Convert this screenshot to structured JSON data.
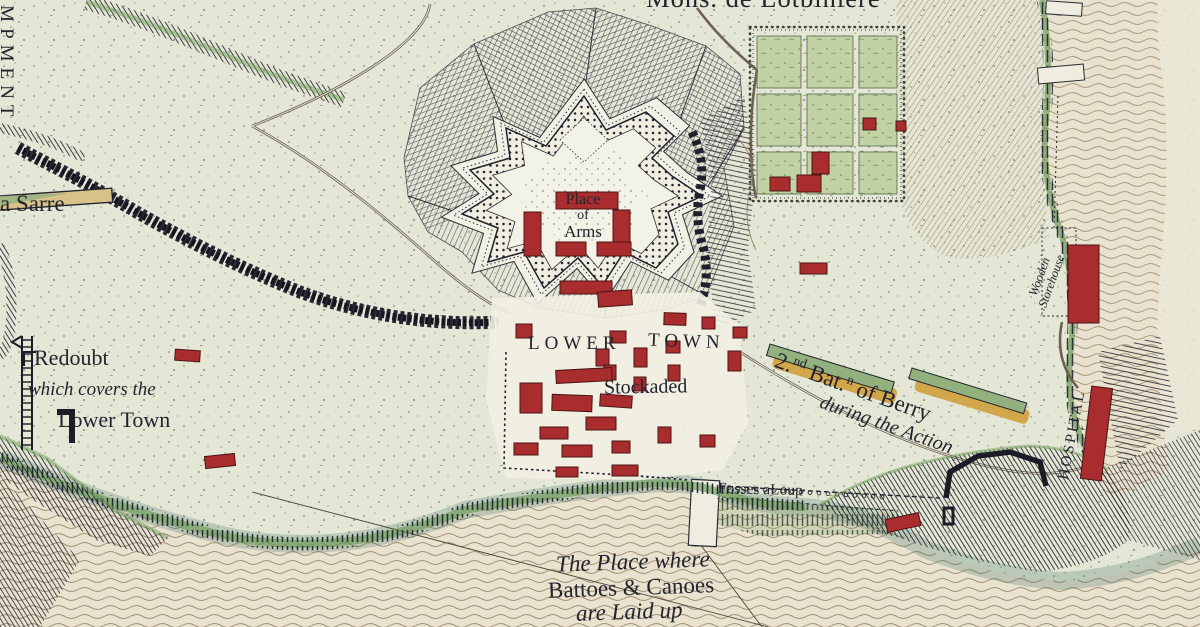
{
  "colors": {
    "ink": "#23232e",
    "paper": "#eae4d2",
    "land": "#e4e7d5",
    "water_shore_teal": "#3e7065",
    "shore_green": "#6c9a58",
    "building_red": "#a92c2e",
    "bar_green": "#93b07f",
    "bar_ochre": "#cf9a33",
    "garden_green": "#c1d3a5",
    "ripple_brown": "#8c7a5c",
    "slope_brown": "#8a6e4f"
  },
  "labels": {
    "officer": "Mons. de Lotbiniere",
    "encampment": "ENCAMPMENT",
    "regiment_la_sarre": "La Sarre",
    "place_of_arms": {
      "l1": "Place",
      "l2": "of",
      "l3": "Arms"
    },
    "lower_town": {
      "w1": "LOWER",
      "w2": "TOWN",
      "stockaded": "Stockaded"
    },
    "redoubt": {
      "l1": "Redoubt",
      "l2": "which covers the",
      "l3": "Lower Town"
    },
    "berry": {
      "n": "2.",
      "sup1": "nd",
      "bat": " Bat.",
      "sup2": "n",
      "rest": " of Berry",
      "action": "during the Action"
    },
    "storehouse": {
      "l1": "Wooden",
      "l2": "Storehouse"
    },
    "hospital": "HOSPITAL",
    "fosses": "Fosses aLoup",
    "battoes": {
      "l1": "The Place where",
      "l2": "Battoes & Canoes",
      "l3": "are Laid up"
    }
  }
}
